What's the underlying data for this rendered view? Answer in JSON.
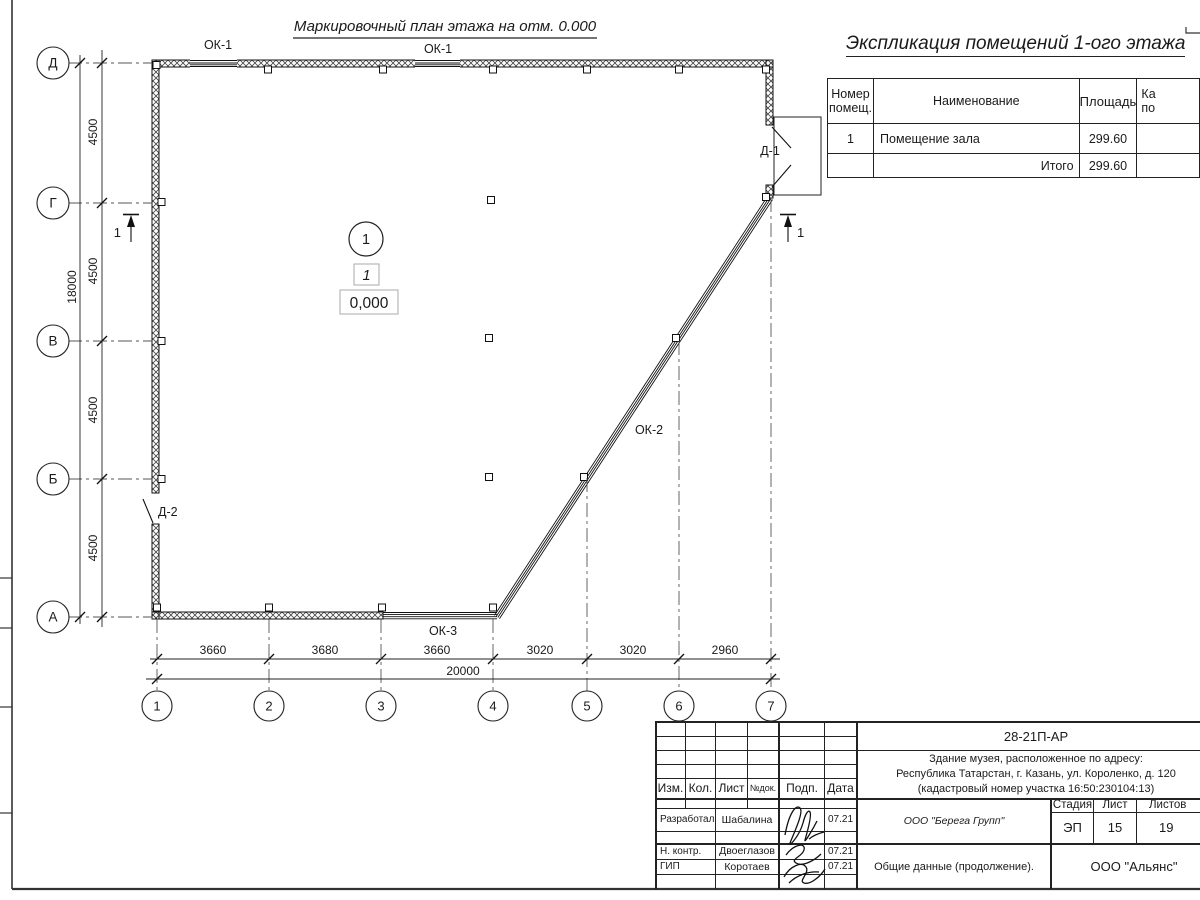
{
  "drawing": {
    "plan_title": "Маркировочный план этажа на отм. 0.000",
    "row_axes": [
      "Д",
      "Г",
      "В",
      "Б",
      "А"
    ],
    "col_axes": [
      "1",
      "2",
      "3",
      "4",
      "5",
      "6",
      "7"
    ],
    "v_dims": [
      "4500",
      "4500",
      "4500",
      "4500"
    ],
    "v_total": "18000",
    "h_dims": [
      "3660",
      "3680",
      "3660",
      "3020",
      "3020",
      "2960"
    ],
    "h_total": "20000",
    "window_label_1": "ОК-1",
    "window_label_2": "ОК-1",
    "window_label_diag": "ОК-2",
    "window_label_bottom": "ОК-3",
    "door_label_1": "Д-1",
    "door_label_2": "Д-2",
    "room_number": "1",
    "room_type_mark": "1",
    "elevation_mark": "0,000",
    "section_mark_left": "1",
    "section_mark_right": "1"
  },
  "explication": {
    "title": "Экспликация помещений 1-ого этажа",
    "col_number_l1": "Номер",
    "col_number_l2": "помещ.",
    "col_name": "Наименование",
    "col_area": "Площадь",
    "col_cut_l1": "Ка",
    "col_cut_l2": "по",
    "rows": [
      {
        "number": "1",
        "name": "Помещение зала",
        "area": "299.60"
      }
    ],
    "total_label": "Итого",
    "total_value": "299.60"
  },
  "titleblock": {
    "doc_number": "28-21П-АР",
    "project_address_l1": "Здание музея, расположенное по адресу:",
    "project_address_l2": "Республика Татарстан, г. Казань, ул. Короленко, д. 120",
    "project_address_l3": "(кадастровый номер участка 16:50:230104:13)",
    "col_izm": "Изм.",
    "col_kol": "Кол.",
    "col_list": "Лист",
    "col_ndoc": "№док.",
    "col_podp": "Подп.",
    "col_data": "Дата",
    "row1_role": "Разработал",
    "row1_name": "Шабалина",
    "row1_date": "07.21",
    "row2_role": "Н. контр.",
    "row2_name": "Двоеглазов",
    "row2_date": "07.21",
    "row3_role": "ГИП",
    "row3_name": "Коротаев",
    "row3_date": "07.21",
    "designer_company": "ООО \"Берега Групп\"",
    "stage_label": "Стадия",
    "sheet_label": "Лист",
    "sheets_label": "Листов",
    "stage_value": "ЭП",
    "sheet_value": "15",
    "sheets_value": "19",
    "doc_title": "Общие данные (продолжение).",
    "contractor_company": "ООО \"Альянс\""
  }
}
